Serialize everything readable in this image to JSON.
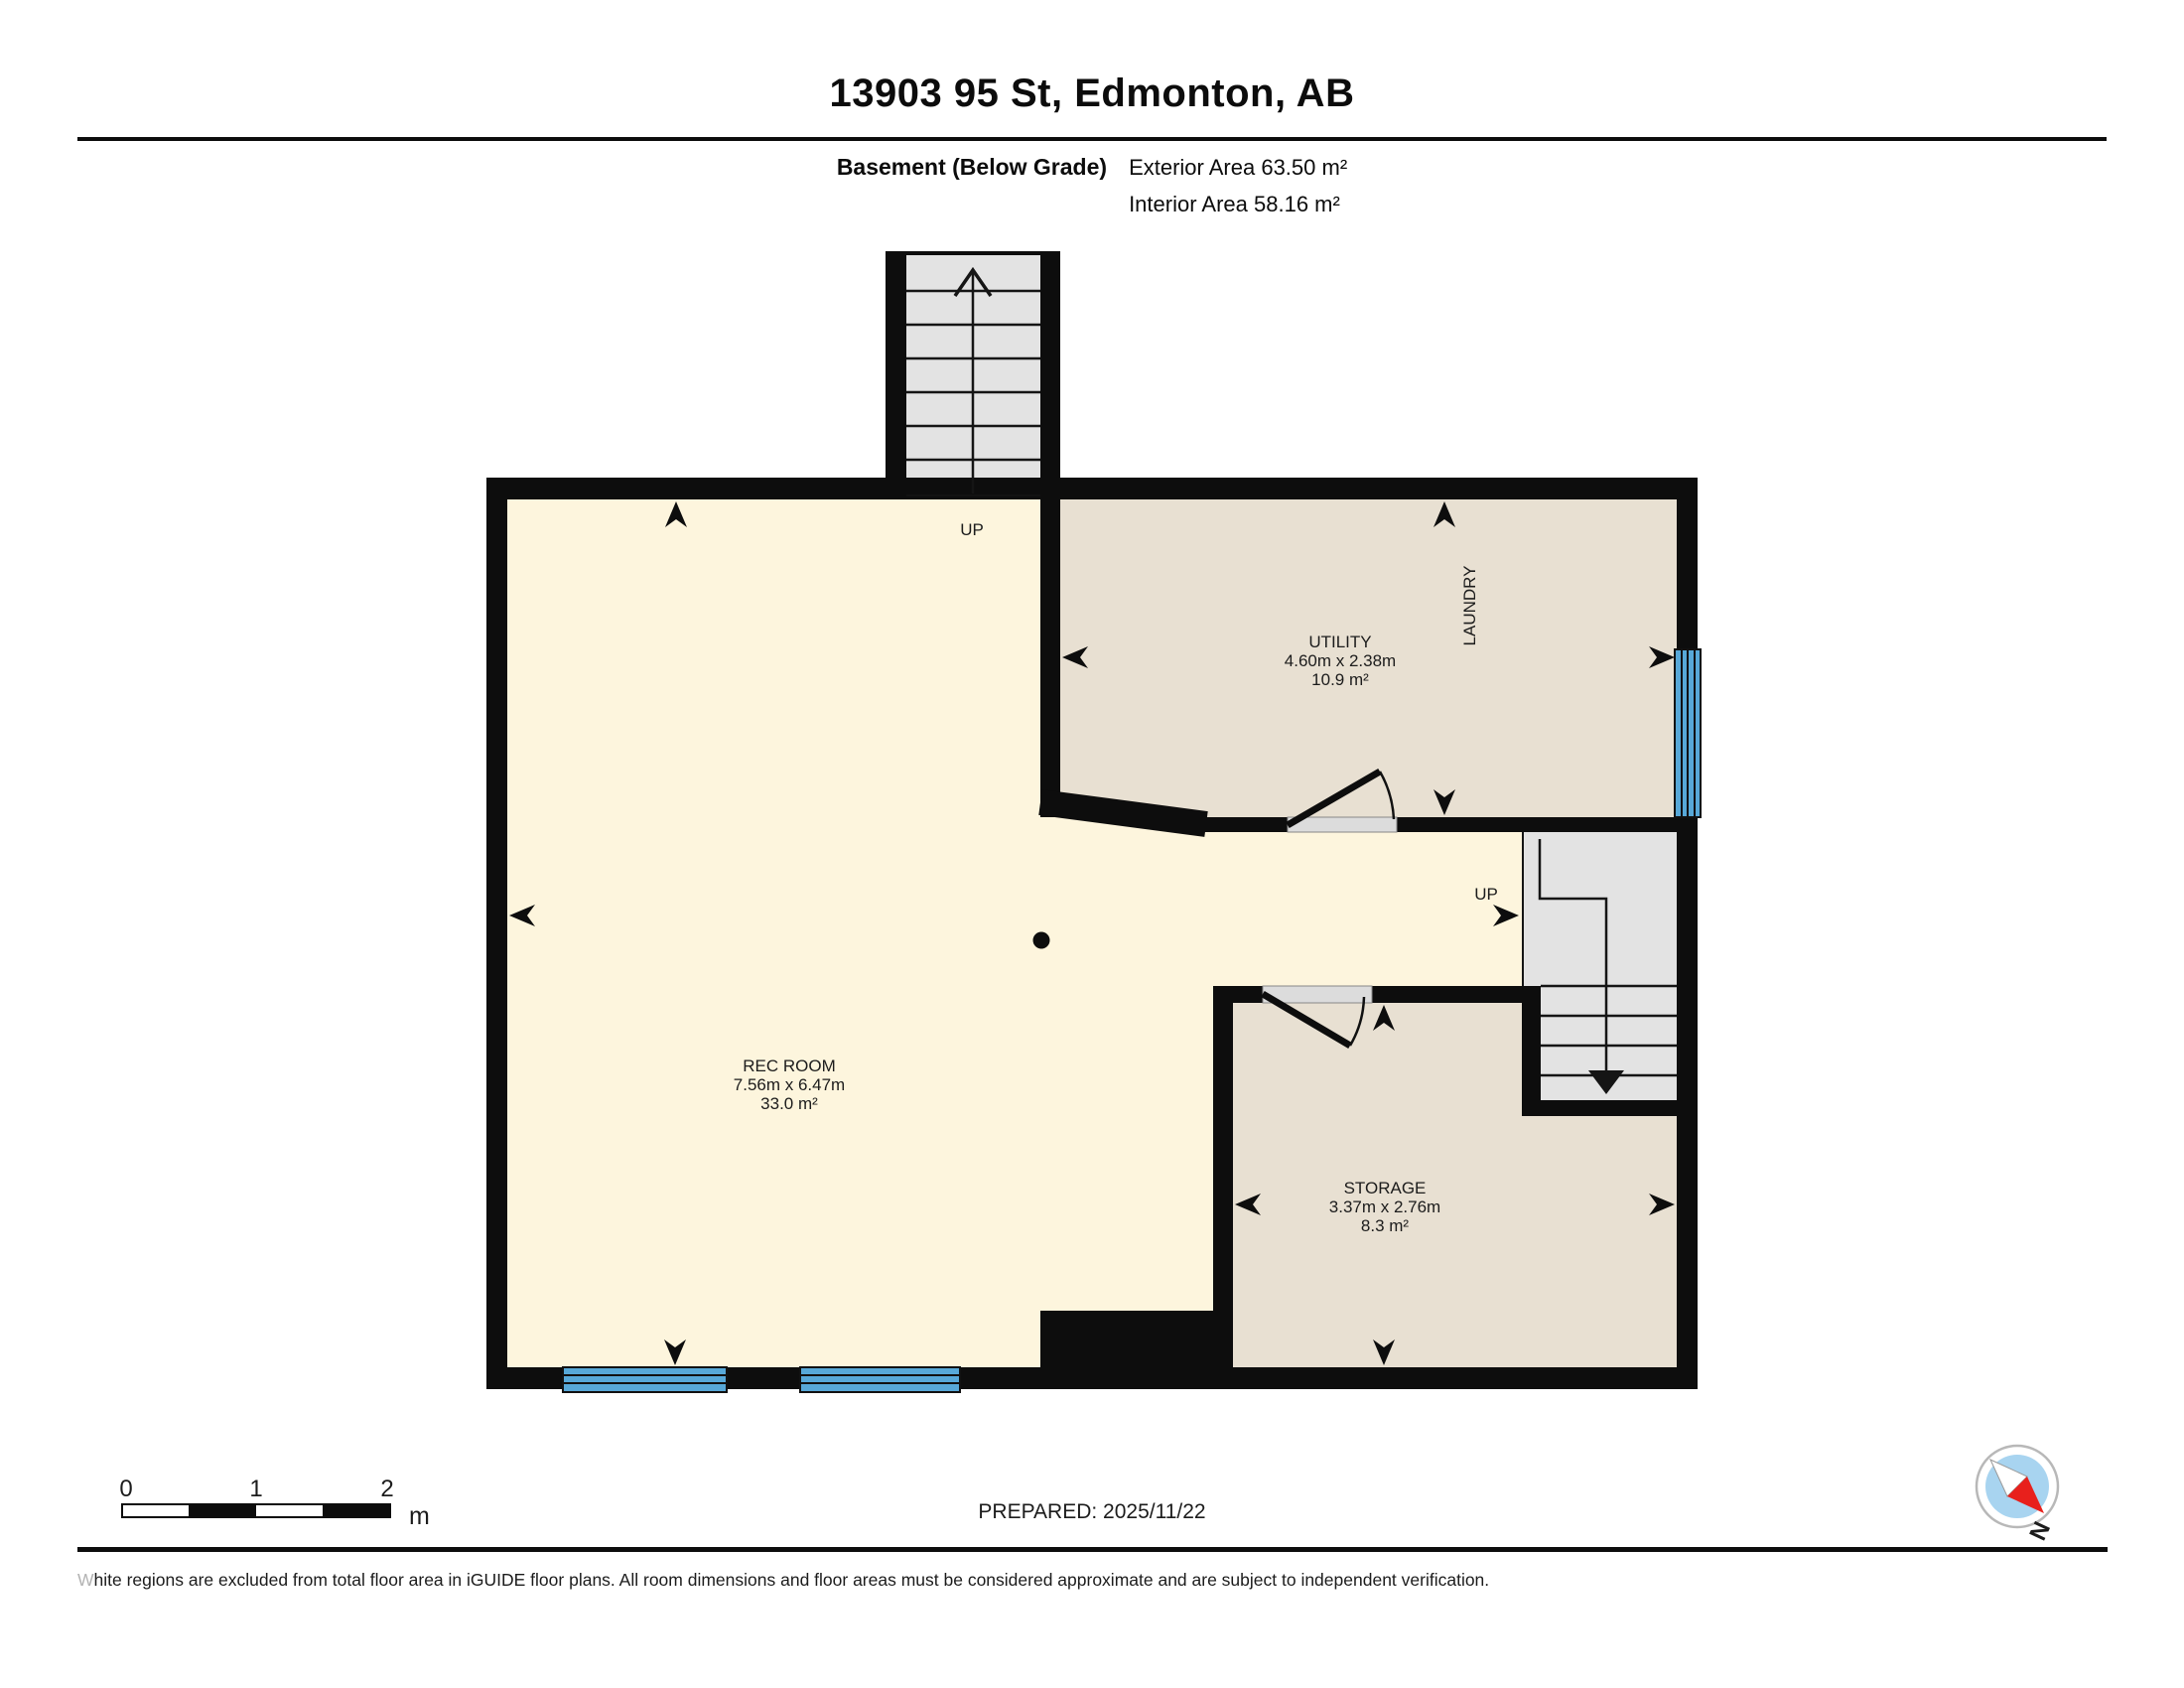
{
  "header": {
    "title": "13903 95 St, Edmonton, AB",
    "floor_label": "Basement (Below Grade)",
    "exterior_area": "Exterior Area 63.50 m²",
    "interior_area": "Interior Area 58.16 m²"
  },
  "plan": {
    "rooms": [
      {
        "name": "UTILITY",
        "dims": "4.60m x 2.38m",
        "area": "10.9 m²"
      },
      {
        "name": "REC ROOM",
        "dims": "7.56m x 6.47m",
        "area": "33.0 m²"
      },
      {
        "name": "STORAGE",
        "dims": "3.37m x 2.76m",
        "area": "8.3 m²"
      },
      {
        "name": "LAUNDRY",
        "dims": "",
        "area": ""
      }
    ],
    "stair_labels": {
      "top_up": "UP",
      "right_up": "UP"
    }
  },
  "scale_bar": {
    "ticks": [
      "0",
      "1",
      "2"
    ],
    "unit": "m"
  },
  "footer": {
    "prepared": "PREPARED: 2025/11/22",
    "disclaimer_lead": "W",
    "disclaimer_rest": "hite regions are excluded from total floor area in iGUIDE floor plans. All room dimensions and floor areas must be considered approximate and are subject to independent verification."
  },
  "compass": {
    "north_label": "N"
  },
  "colors": {
    "wall_black": "#0d0d0d",
    "room_fill_cream": "#fdf5dd",
    "room_fill_beige": "#e8e0d2",
    "stairs_fill": "#e3e3e3",
    "window_blue": "#57a8d8",
    "door_sill_gray": "#dcdcdc",
    "compass_inner_blue": "#a8d4f0",
    "compass_needle_red": "#e8201c",
    "disclaimer_lead_gray": "#b3b3b3"
  }
}
